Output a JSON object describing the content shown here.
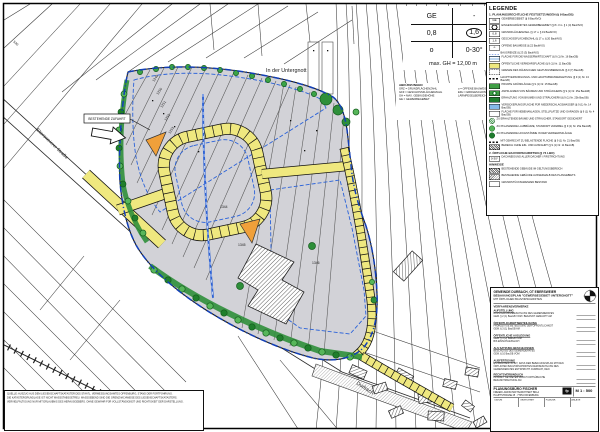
{
  "map": {
    "area_label": "In der Untergnott",
    "stream_label": "Durbach",
    "street_label": "Ebersweierer Straße",
    "road_number": "530",
    "callout_label": "BESTEHENDE ZUFAHRT",
    "parcels": [
      "1249",
      "1250",
      "1251",
      "1252",
      "1253",
      "1344",
      "1345",
      "1346"
    ]
  },
  "schablone": {
    "ge": "GE",
    "dash": "-",
    "grz": "0,8",
    "gfz": "1,6",
    "bauweise": "o",
    "dachneigung": "0-30°",
    "max_gh": "max. GH = 12,00 m"
  },
  "mini_legend": {
    "title": "ABKÜRZUNGEN",
    "lines": [
      "GRZ = GRUNDFLÄCHENZAHL",
      "GFZ = GESCHOSSFLÄCHENZAHL",
      "GH = MAX. GEBÄUDEHÖHE",
      "GE = GEWERBEGEBIET",
      "o = OFFENE BAUWEISE",
      "EFH = ERDGESCHOSSFUSSBODENHÖHE",
      "LÄRMPEGELBEREICH III"
    ]
  },
  "legend": {
    "title": "LEGENDE",
    "sections": [
      {
        "title": "1. PLANUNGSRECHTLICHE FESTSETZUNGEN (§ 9 BauGB)",
        "items": [
          {
            "sym": "plain",
            "chip": "GE",
            "label": "GEWERBEGEBIET (§ 8 BauNVO)"
          },
          {
            "sym": "circle",
            "chip": "",
            "label": "EINGESCHRÄNKTES GEWERBEGEBIET (§ 8 i.V.m. § 1 (4) BauNVO)"
          },
          {
            "sym": "plain",
            "chip": "0,8",
            "label": "GRUNDFLÄCHENZAHL (§ 17 u. § 19 BauNVO)"
          },
          {
            "sym": "plain",
            "chip": "1,6",
            "label": "GESCHOSSFLÄCHENZAHL (§ 17 u. § 20 BauNVO)"
          },
          {
            "sym": "plain",
            "chip": "o",
            "label": "OFFENE BAUWEISE (§ 22 BauNVO)"
          },
          {
            "sym": "bluedash",
            "chip": "",
            "label": "BAUGRENZE (§ 23 (3) BauNVO)"
          },
          {
            "sym": "bluelines",
            "chip": "",
            "label": "FLÄCHE FÜR DIE WASSERWIRTSCHAFT (§ 9 (1) Nr. 16 BauGB)"
          },
          {
            "sym": "yellow",
            "chip": "",
            "label": "ÖFFENTLICHE VERKEHRSFLÄCHE (§ 9 (1) Nr. 11 BauGB)"
          },
          {
            "sym": "gb",
            "chip": "",
            "label": "GRENZE DES RÄUMLICHEN GELTUNGSBEREICHS (§ 9 (7) BauGB)"
          },
          {
            "sym": "blackdash",
            "chip": "",
            "label": "HAUPTVERSORGUNGS- UND HAUPTABWASSERLEITUNG (§ 9 (1) Nr. 13 BauGB)"
          },
          {
            "sym": "green",
            "chip": "",
            "label": "PRIVATE GRÜNFLÄCHE (§ 9 (1) Nr. 15 BauGB)"
          },
          {
            "sym": "greenT",
            "chip": "",
            "label": "ANPFLANZEN VON BÄUMEN UND STRÄUCHERN (§ 9 (1) Nr. 25a BauGB)"
          },
          {
            "sym": "greenD",
            "chip": "",
            "label": "ERHALTUNG VON BÄUMEN UND STRÄUCHERN (§ 9 (1) Nr. 25b BauGB)"
          },
          {
            "sym": "blue",
            "chip": "",
            "label": "VERSICKERUNGSFLÄCHE FÜR NIEDERSCHLAGSWASSER (§ 9 (1) Nr. 14 BauGB)"
          },
          {
            "sym": "plainB",
            "chip": "",
            "label": "FLÄCHE FÜR NEBENANLAGEN, STELLPLÄTZE UND GARAGEN (§ 9 (1) Nr. 4 BauGB)"
          },
          {
            "sym": "treeH",
            "chip": "",
            "label": "ZU ERHALTENDE BÄUME UND STRÄUCHER, STANDORT GESICHERT"
          },
          {
            "sym": "tree",
            "chip": "",
            "label": "ZU PFLANZENDE LAUBBÄUME, STANDORT VARIABEL (§ 9 (1) Nr. 25a BauGB)"
          },
          {
            "sym": "treeD",
            "chip": "",
            "label": "ZU PFLANZENDE HOCHSTÄMME IN DER VERKEHRSFLÄCHE"
          },
          {
            "sym": "blackdash",
            "chip": "",
            "label": "MIT GEHRECHT ZU BELASTENDE FLÄCHE (§ 9 (1) Nr. 21 BauGB)"
          },
          {
            "sym": "hatch",
            "chip": "",
            "label": "BEREICH OHNE EIN- UND AUSFAHRT (§ 9 (1) Nr. 11 BauGB)"
          }
        ]
      },
      {
        "title": "2. ÖRTLICHE BAUVORSCHRIFTEN (§ 74 LBO)",
        "items": [
          {
            "sym": "plain",
            "chip": "0-30°",
            "label": "DACHNEIGUNG ALLER DÄCHER / FIRSTRICHTUNG"
          }
        ]
      },
      {
        "title": "HINWEISE",
        "items": [
          {
            "sym": "hatch",
            "chip": "",
            "label": "BESTEHENDE GEBÄUDE IM GELTUNGSBEREICH"
          },
          {
            "sym": "hatch2",
            "chip": "",
            "label": "BESTEHENDE GEBÄUDE AUSSERHALB DES PLANGEBIETS"
          },
          {
            "sym": "plain",
            "chip": "",
            "label": "GRUNDSTÜCKSGRENZEN BESTAND"
          }
        ]
      }
    ]
  },
  "titleblock": {
    "line1": "GEMEINDE DURBACH, OT EBERSWEIER",
    "line2": "BEBAUUNGSPLAN \"GEWERBEGEBIET UNTERGNOTT\"",
    "line3": "MIT ÖRTLICHEN BAUVORSCHRIFTEN",
    "line4": "VERFAHRENSVERMERKE",
    "sections": [
      {
        "h": "AUFSTELLUNG",
        "lines": [
          "AUFSTELLUNGSBESCHLUSS DES GEMEINDERATES",
          "GEM. § 2 (1) BauGB VOM / BEKANNT GEMACHT AM"
        ]
      },
      {
        "h": "ÖFFENTLICHKEITSBETEILIGUNG",
        "lines": [
          "FRÜHZEITIGE BETEILIGUNG DER ÖFFENTLICHKEIT",
          "GEM. § 3 (1) BauGB AM"
        ]
      },
      {
        "h": "ÖFFENTLICHE AUSLEGUNG",
        "lines": [
          "GEM. § 3 (2) BauGB VOM",
          "BIS EINSCHLIESSLICH"
        ]
      },
      {
        "h": "ALS SATZUNG BESCHLOSSEN",
        "lines": [
          "BESCHLUSS DES GEMEINDERATES",
          "GEM. § 10 BauGB VOM"
        ]
      },
      {
        "h": "AUSFERTIGUNG",
        "lines": [
          "ES WIRD BESTÄTIGT, DASS DER BEBAUUNGSPLAN MIT DEN",
          "ÖRTLICHEN BAUVORSCHRIFTEN DEM BESCHLUSS DES",
          "GEMEINDERATES ENTSPRICHT.  DURBACH, DEN"
        ]
      },
      {
        "h": "RECHTSVERBINDLICH",
        "lines": [
          "IN KRAFT GETRETEN DURCH ORTSÜBLICHE",
          "BEKANNTMACHUNG AM"
        ]
      }
    ],
    "firm": {
      "name": "PLANUNGSBÜRO FISCHER",
      "addr1": "FREIER LANDSCHAFTSARCHITEKT BDLA",
      "addr2": "HAUPTSTRASSE 25 · 77654 OFFENBURG",
      "logo": "fp",
      "scale": "M 1 : 500",
      "cells": [
        "DATUM",
        "GEZEICHNET",
        "PLAN-NR.",
        "ANLAGE"
      ]
    }
  },
  "disclaimer": {
    "lines": [
      "QUELLE: AUSZUG AUS DEM LIEGENSCHAFTSKATASTER DES STAATL. VERMESSUNGSAMTES OFFENBURG, STAND DER FORTFÜHRUNG.",
      "DIE KATASTERGRUNDLAGE IST NICHT MASSSTABSGETREU. MASSGEBEND SIND DIE GRENZNACHWEISE DES LIEGENSCHAFTSKATASTERS.",
      "VERVIELFÄLTIGUNG NUR MIT ERLAUBNIS DES HERAUSGEBERS. OHNE GEWÄHR FÜR VOLLSTÄNDIGKEIT UND RICHTIGKEIT DER DARSTELLUNG."
    ]
  }
}
